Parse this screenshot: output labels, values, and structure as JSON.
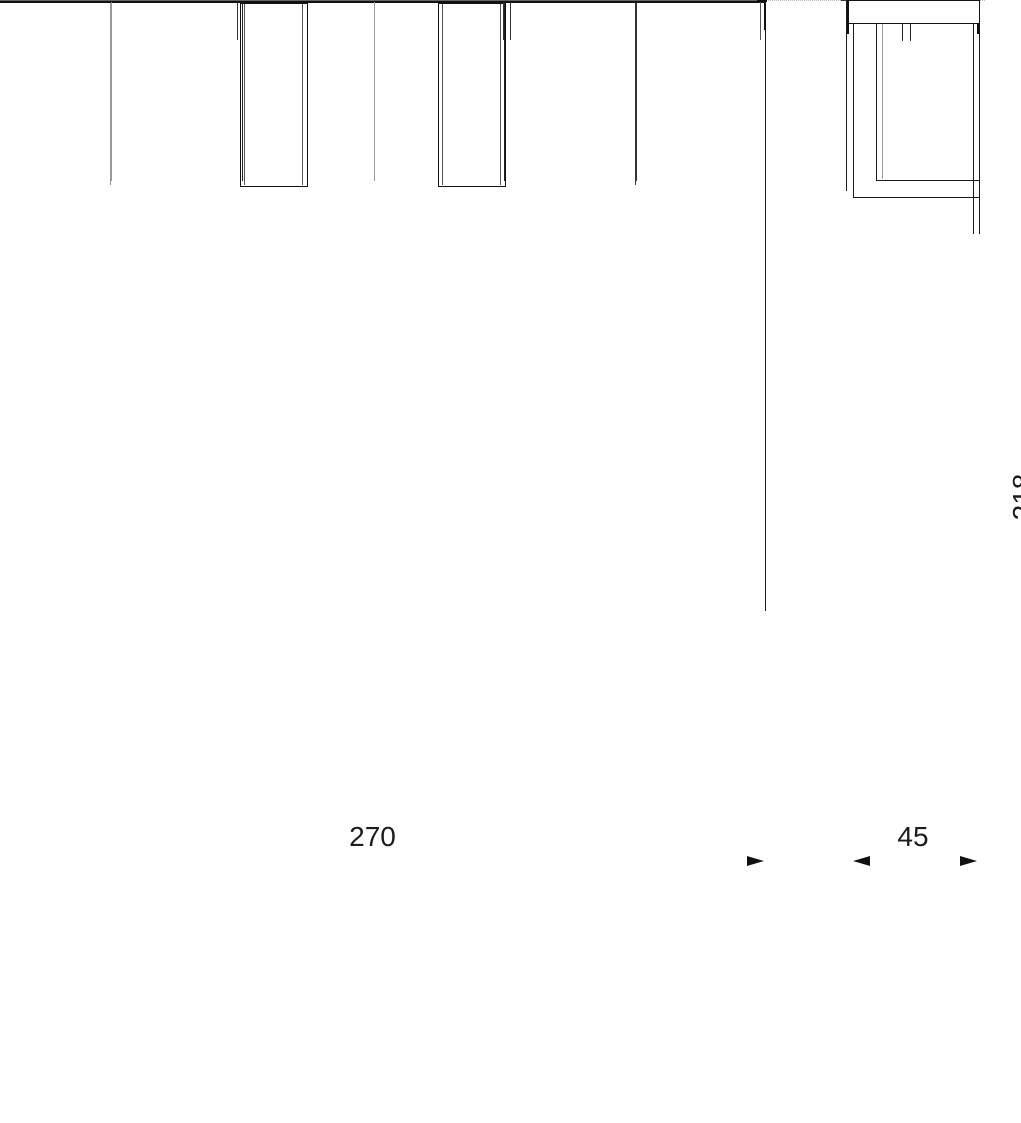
{
  "canvas": {
    "background": "#ffffff",
    "ink_color": "#1a1a1a",
    "dim_line_color": "#666666"
  },
  "dimensions": {
    "front_width": "270",
    "side_depth": "45",
    "total_height": "218"
  }
}
